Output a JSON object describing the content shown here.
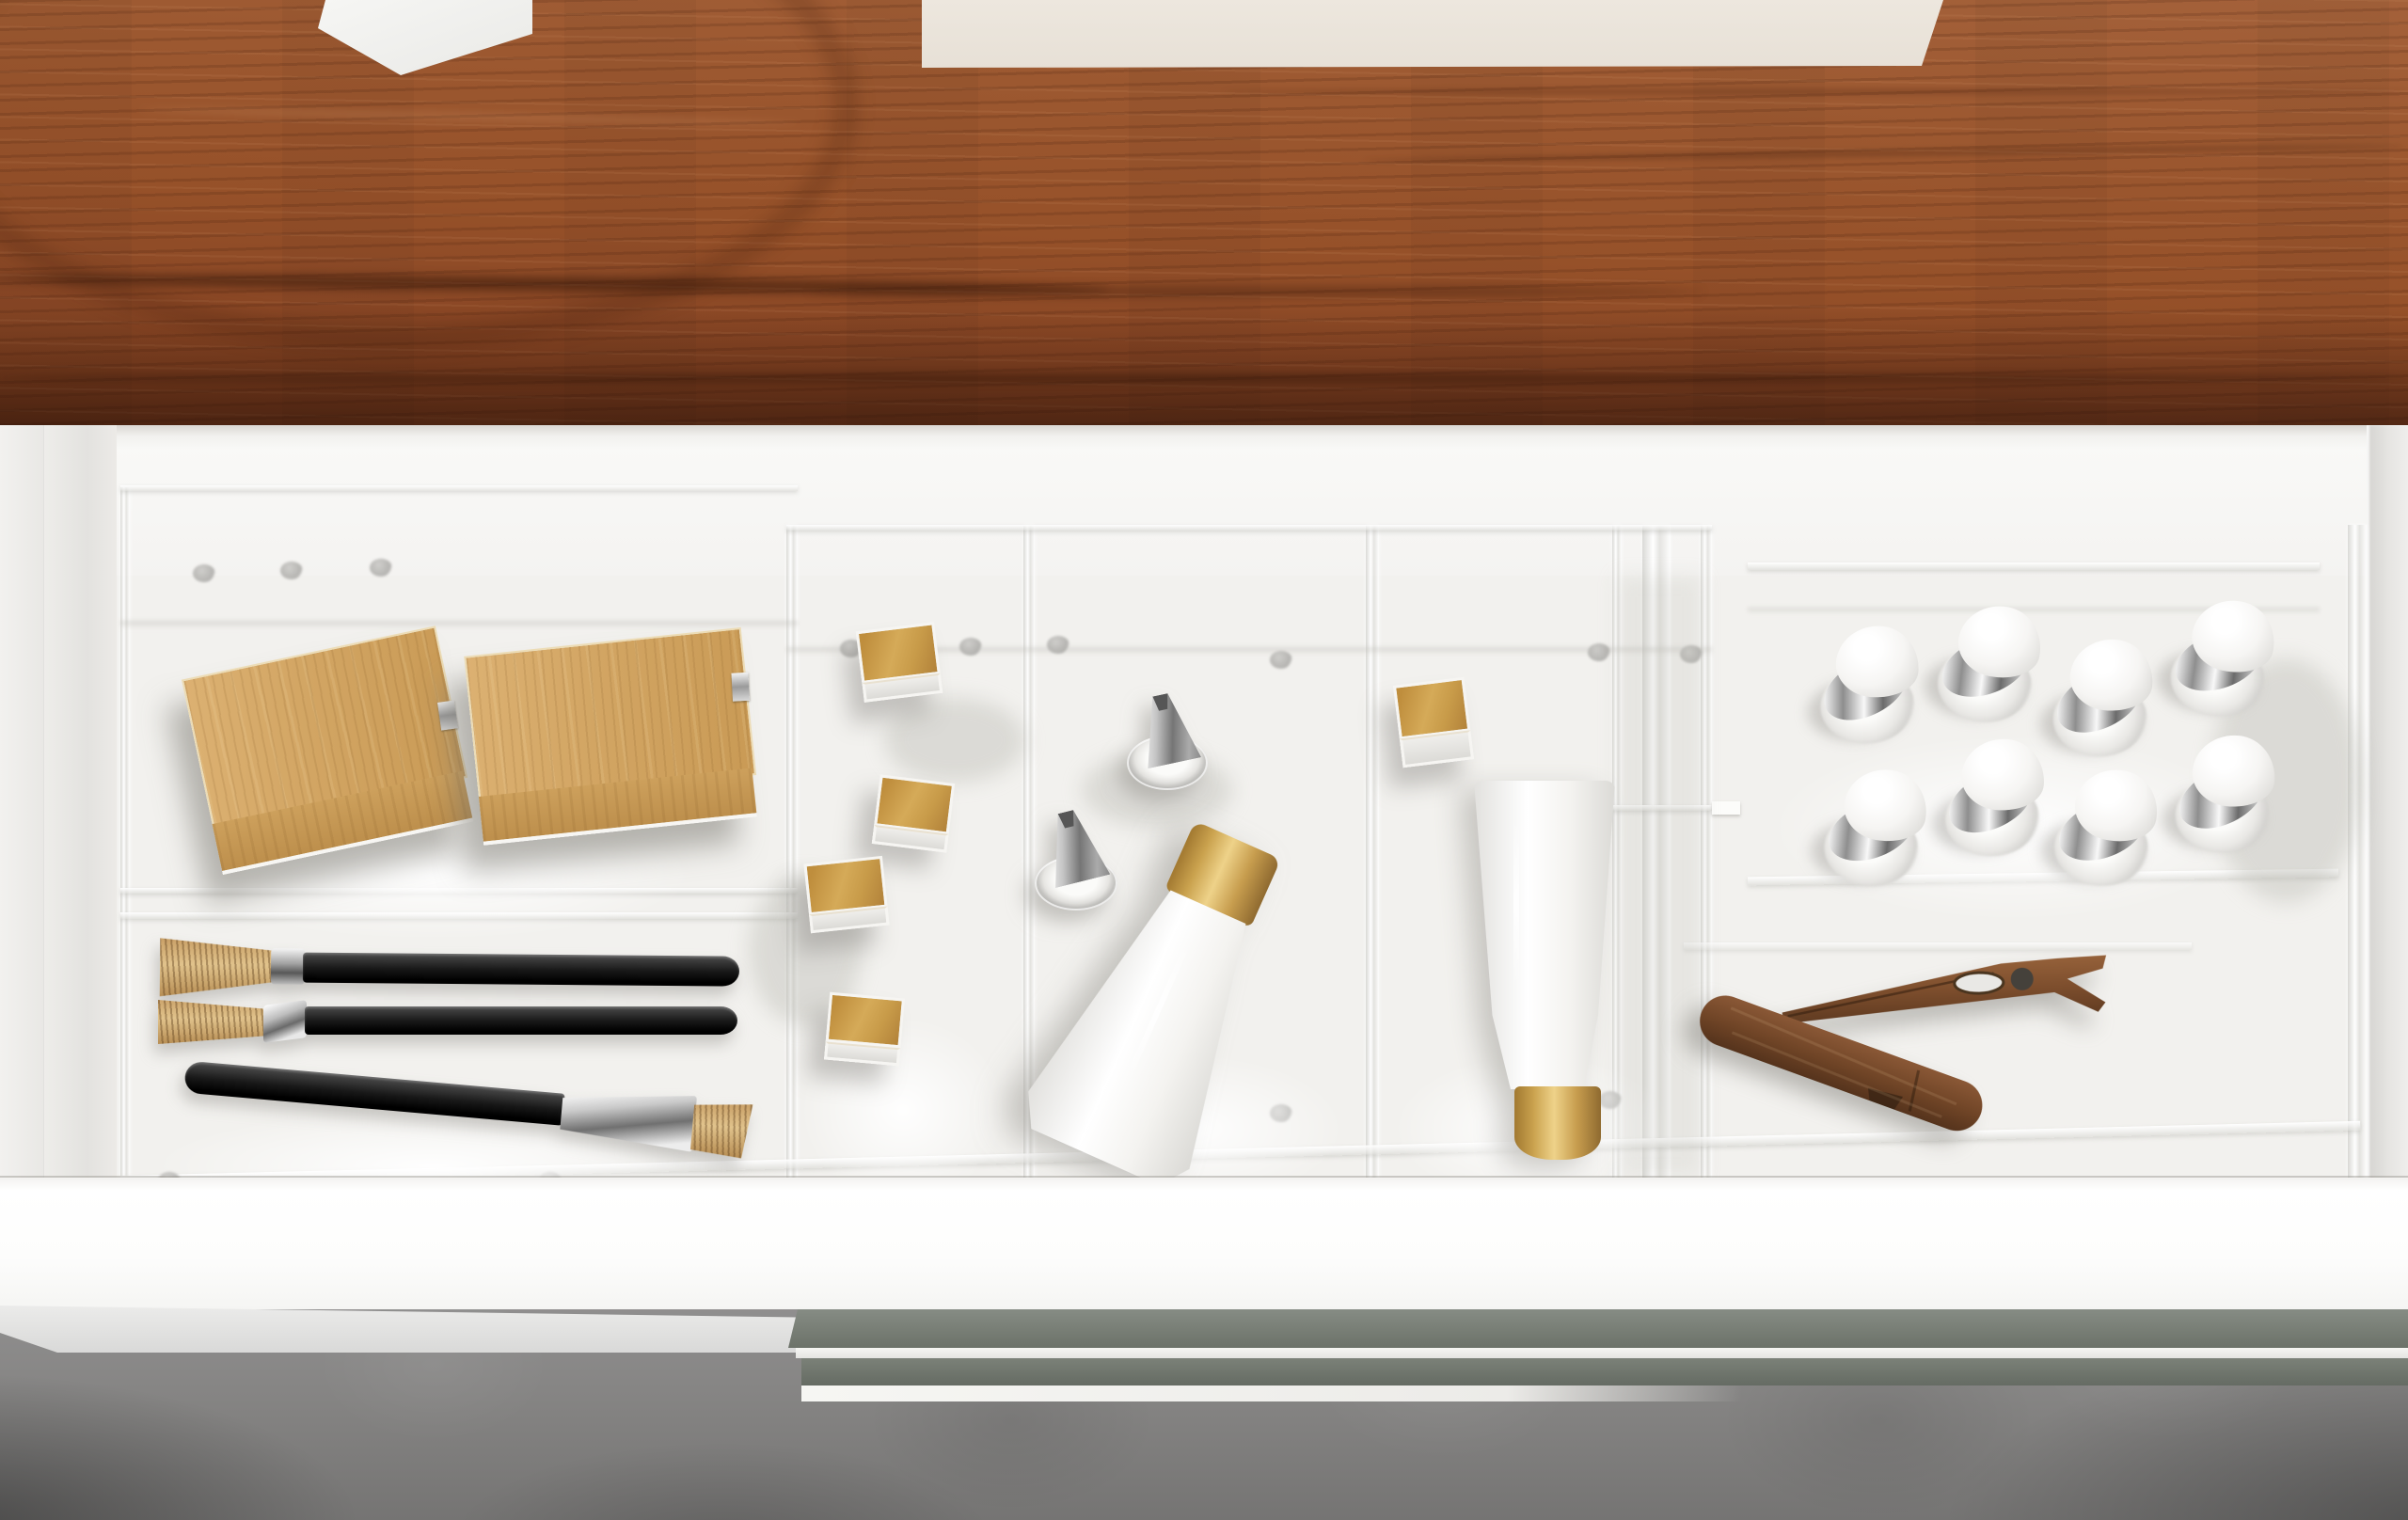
{
  "scene": {
    "description": "Top-down 3D render of an open white vanity drawer beneath a dark walnut countertop; a clear acrylic organizer inside holds cosmetics and tools; gray concrete floor below.",
    "regions": {
      "countertop": {
        "label": "Walnut wood countertop",
        "color": "#96522c"
      },
      "wall_strip": {
        "label": "Cream wall visible above countertop",
        "color": "#eae4da"
      },
      "counter_object": {
        "label": "White object on countertop",
        "color": "#f3f3f1"
      },
      "drawer": {
        "label": "Open white drawer",
        "face_color": "#fbfbfa",
        "interior_color": "#f2f1ef",
        "handle_color": "#6e756d"
      },
      "organizer": {
        "label": "Clear acrylic drawer organizer",
        "sections": 5,
        "color": "#eceded"
      },
      "floor": {
        "label": "Gray concrete floor",
        "color": "#7f7e7d"
      }
    },
    "items": {
      "wooden_boxes": {
        "label": "Light wood storage boxes with metal clasps",
        "count": 2,
        "color": "#d2a566"
      },
      "makeup_brushes": {
        "label": "Flat makeup brushes with black handles",
        "count": 3,
        "handle_color": "#1c1c1c",
        "bristle_color": "#cda46c",
        "ferrule_color": "#c0c0c0"
      },
      "gold_lipsticks": {
        "label": "White lipsticks with square gold caps",
        "count": 5,
        "cap_color": "#d2a855"
      },
      "silver_jars": {
        "label": "Clear jars with silver cone caps",
        "count": 2,
        "cap_color": "#9c9c9c"
      },
      "tilted_tube": {
        "label": "White cosmetic tube with gold cap, lying tilted",
        "count": 1,
        "cap_color": "#d6b168"
      },
      "standing_tube": {
        "label": "White cosmetic tube standing on its gold cap",
        "count": 1,
        "cap_color": "#d6b168"
      },
      "white_cap_bottles": {
        "label": "Small bottles with white caps and silver collars",
        "count": 8,
        "rows": 2
      },
      "wooden_clips": {
        "label": "Wooden clips",
        "count": 2,
        "color": "#7d4e2d"
      }
    }
  }
}
